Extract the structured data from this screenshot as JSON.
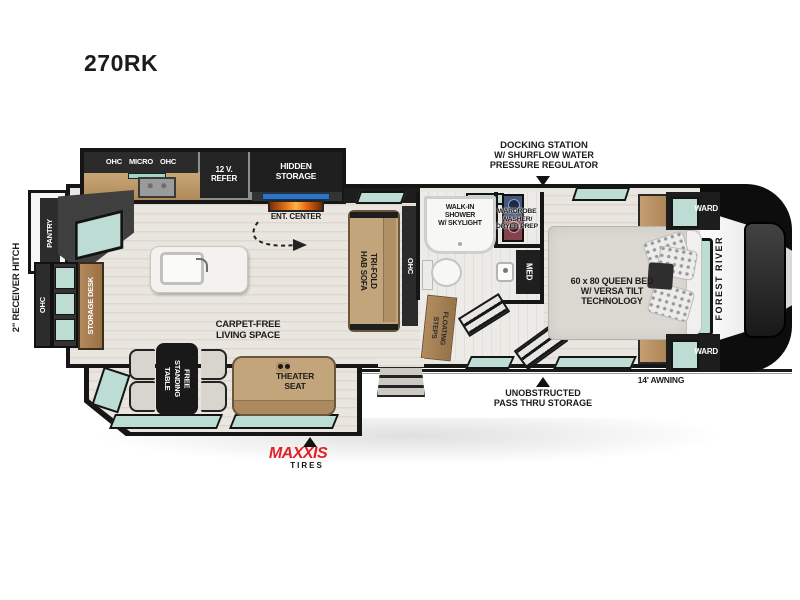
{
  "meta": {
    "model": "270RK",
    "brand_cap": "FOREST RIVER"
  },
  "exterior": {
    "receiver_hitch": "2\" RECEIVER HITCH",
    "awning": "14' AWNING",
    "docking": {
      "line1": "DOCKING STATION",
      "line2": "W/ SHURFLOW WATER",
      "line3": "PRESSURE REGULATOR"
    },
    "pass_thru": {
      "line1": "UNOBSTRUCTED",
      "line2": "PASS THRU STORAGE"
    },
    "tires": {
      "brand": "MAXXIS",
      "word": "TIRES"
    }
  },
  "kitchen": {
    "ohc_left": "OHC",
    "micro": "MICRO",
    "ohc_right": "OHC",
    "refer": {
      "line1": "12 V.",
      "line2": "REFER"
    },
    "hidden_storage": {
      "line1": "HIDDEN",
      "line2": "STORAGE"
    },
    "ent_center": "ENT. CENTER"
  },
  "living": {
    "carpet_free": {
      "line1": "CARPET-FREE",
      "line2": "LIVING SPACE"
    },
    "sofa": {
      "line1": "TRI-FOLD",
      "line2": "HAB SOFA"
    },
    "ohc_sofa": "OHC",
    "theater": {
      "line1": "THEATER",
      "line2": "SEAT"
    },
    "table": {
      "line1": "FREE",
      "line2": "STANDING",
      "line3": "TABLE"
    }
  },
  "rear": {
    "pantry": "PANTRY",
    "ohc": "OHC",
    "storage_desk": "STORAGE DESK"
  },
  "bath": {
    "shower": {
      "line1": "WALK-IN",
      "line2": "SHOWER",
      "line3": "W/ SKYLIGHT"
    },
    "wardrobe": {
      "line1": "WARDROBE",
      "line2": "WASHER/",
      "line3": "DRYER PREP"
    },
    "med": "MED",
    "steps": {
      "line1": "FLOATING",
      "line2": "STEPS"
    }
  },
  "bedroom": {
    "bed": {
      "line1": "60 x 80 QUEEN BED",
      "line2": "W/ VERSA TILT",
      "line3": "TECHNOLOGY"
    },
    "ward_top": "WARD",
    "ward_bottom": "WARD"
  },
  "colors": {
    "window_teal": "#bcdcd4",
    "cabinet_dark": "#2b2b2b",
    "wall_black": "#161616",
    "wood": "#b9946a",
    "sofa_tan": "#c3a57b",
    "maxxis_red": "#e02128"
  }
}
